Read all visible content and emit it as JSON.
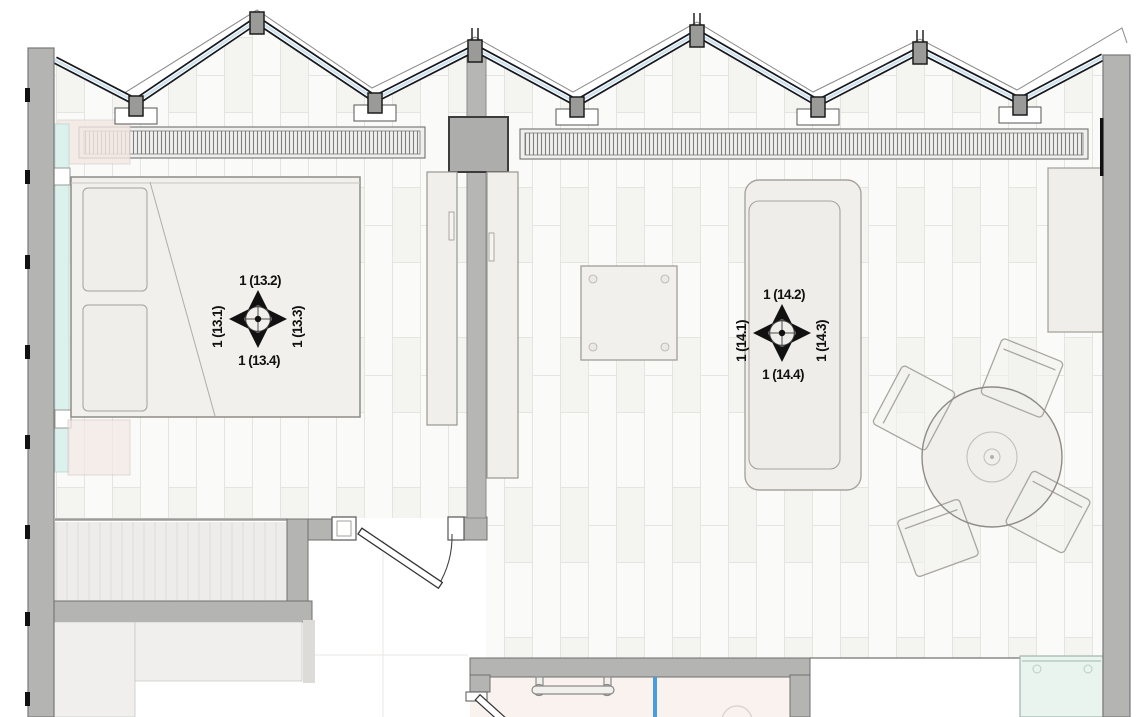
{
  "drawing": {
    "type": "architectural-floor-plan",
    "rooms": [
      "bedroom",
      "living-room",
      "bathroom",
      "closet"
    ]
  },
  "markers": [
    {
      "id": "13",
      "labels": {
        "top": "1 (13.2)",
        "left": "1 (13.1)",
        "right": "1 (13.3)",
        "bottom": "1 (13.4)"
      }
    },
    {
      "id": "14",
      "labels": {
        "top": "1 (14.2)",
        "left": "1 (14.1)",
        "right": "1 (14.3)",
        "bottom": "1 (14.4)"
      }
    }
  ],
  "colors": {
    "wall": "#b4b4b2",
    "glass": "#cfe2f0",
    "glazing_frame": "#16191d",
    "curtain_cyan": "#dcf0ec",
    "pink_item": "#f3e8e4",
    "bath_floor": "#f9f2ee",
    "bath_divider_blue": "#4a9ce0",
    "shower_teal": "#e9f4ef",
    "furniture": "#f1f0ec",
    "floor_line": "#e4e4e0"
  }
}
